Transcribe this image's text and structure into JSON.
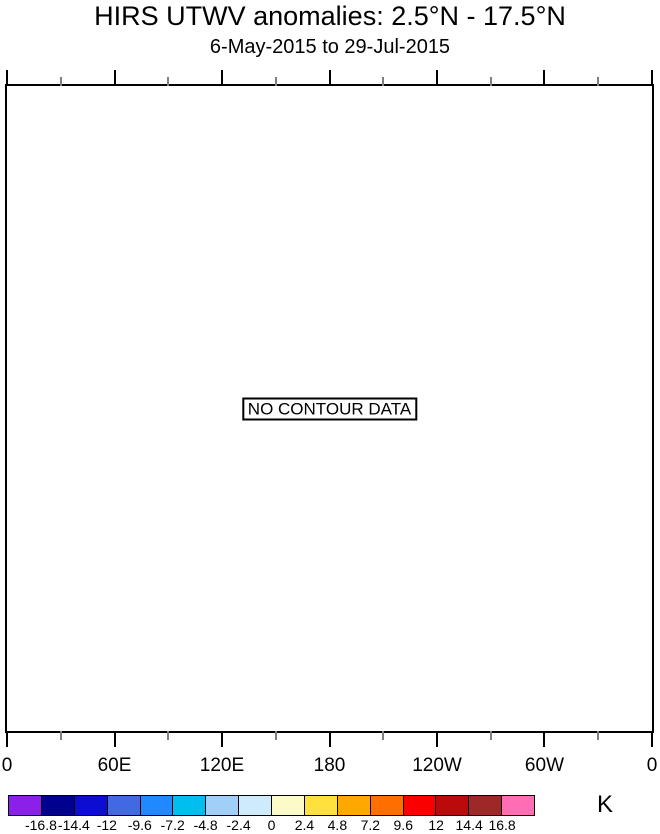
{
  "title": "HIRS UTWV anomalies: 2.5°N - 17.5°N",
  "subtitle": "6-May-2015 to 29-Jul-2015",
  "plot": {
    "no_data_label": "NO CONTOUR DATA"
  },
  "x_axis": {
    "major_ticks": [
      {
        "pos": 0,
        "label": "0"
      },
      {
        "pos": 0.1667,
        "label": "60E"
      },
      {
        "pos": 0.3333,
        "label": "120E"
      },
      {
        "pos": 0.5,
        "label": "180"
      },
      {
        "pos": 0.6667,
        "label": "120W"
      },
      {
        "pos": 0.8333,
        "label": "60W"
      },
      {
        "pos": 1,
        "label": "0"
      }
    ],
    "minor_tick_positions": [
      0.0833,
      0.25,
      0.4167,
      0.5833,
      0.75,
      0.9167
    ],
    "minor_tick_color": "#7f7f7f"
  },
  "colorbar": {
    "units": "K",
    "colors": [
      "#8B20EA",
      "#01018F",
      "#0C0CD2",
      "#4169E1",
      "#2089FF",
      "#00BEEE",
      "#A0CFFA",
      "#CDEBFA",
      "#FBFBC8",
      "#FFE03C",
      "#FFA800",
      "#FF6F00",
      "#FA0000",
      "#BC0A0A",
      "#9E2828",
      "#FF6EB4"
    ],
    "tick_labels": [
      "-16.8",
      "-14.4",
      "-12",
      "-9.6",
      "-7.2",
      "-4.8",
      "-2.4",
      "0",
      "2.4",
      "4.8",
      "7.2",
      "9.6",
      "12",
      "14.4",
      "16.8"
    ]
  },
  "chart_data": {
    "type": "heatmap",
    "title": "HIRS UTWV anomalies: 2.5°N - 17.5°N",
    "subtitle": "6-May-2015 to 29-Jul-2015",
    "xlabel": "Longitude",
    "ylabel": "",
    "x_tick_labels": [
      "0",
      "60E",
      "120E",
      "180",
      "120W",
      "60W",
      "0"
    ],
    "x_range_degrees": [
      0,
      360
    ],
    "values": [],
    "annotation": "NO CONTOUR DATA",
    "grid": false,
    "legend_position": "bottom",
    "colorbar": {
      "units": "K",
      "levels": [
        -16.8,
        -14.4,
        -12,
        -9.6,
        -7.2,
        -4.8,
        -2.4,
        0,
        2.4,
        4.8,
        7.2,
        9.6,
        12,
        14.4,
        16.8
      ],
      "colors": [
        "#8B20EA",
        "#01018F",
        "#0C0CD2",
        "#4169E1",
        "#2089FF",
        "#00BEEE",
        "#A0CFFA",
        "#CDEBFA",
        "#FBFBC8",
        "#FFE03C",
        "#FFA800",
        "#FF6F00",
        "#FA0000",
        "#BC0A0A",
        "#9E2828",
        "#FF6EB4"
      ]
    }
  }
}
